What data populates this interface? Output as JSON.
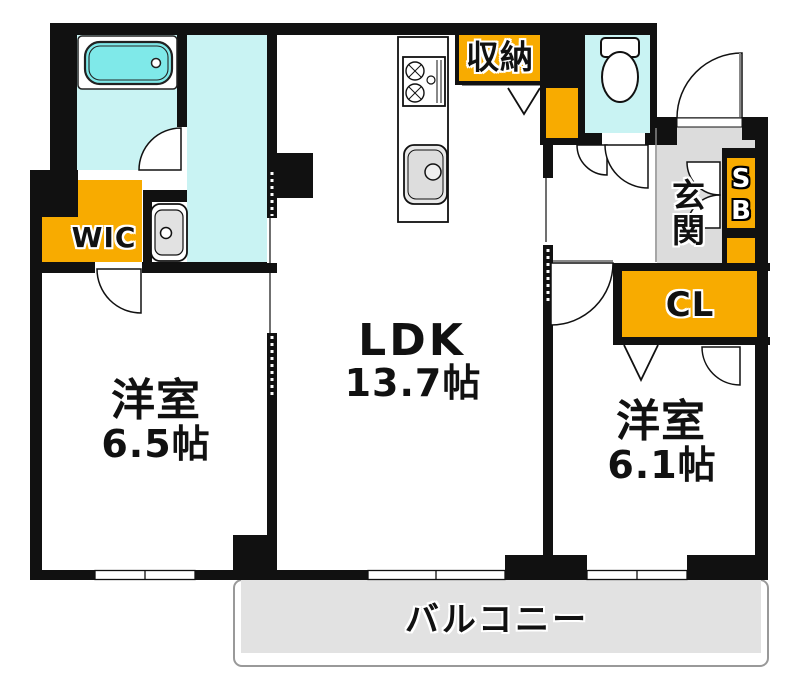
{
  "floorplan": {
    "rooms": {
      "ldk": {
        "name": "LDK",
        "size": "13.7帖"
      },
      "bedroom_west": {
        "name": "洋室",
        "size": "6.5帖"
      },
      "bedroom_east": {
        "name": "洋室",
        "size": "6.1帖"
      },
      "wic": {
        "label": "WIC"
      },
      "storage": {
        "label": "収納"
      },
      "entrance": {
        "label": "玄関"
      },
      "shoe_box": {
        "label": "SB"
      },
      "closet": {
        "label": "CL"
      },
      "balcony": {
        "label": "バルコニー"
      }
    },
    "fixtures": [
      "bathtub-icon",
      "toilet-icon",
      "washbasin-icon",
      "kitchen-sink-icon",
      "gas-stove-icon"
    ],
    "colors": {
      "wall": "#111111",
      "water": "#c9f3f3",
      "tub": "#7fe9e9",
      "orange": "#f8ab00",
      "entrance": "#dcdcdc",
      "balcony": "#e2e2e2"
    }
  }
}
